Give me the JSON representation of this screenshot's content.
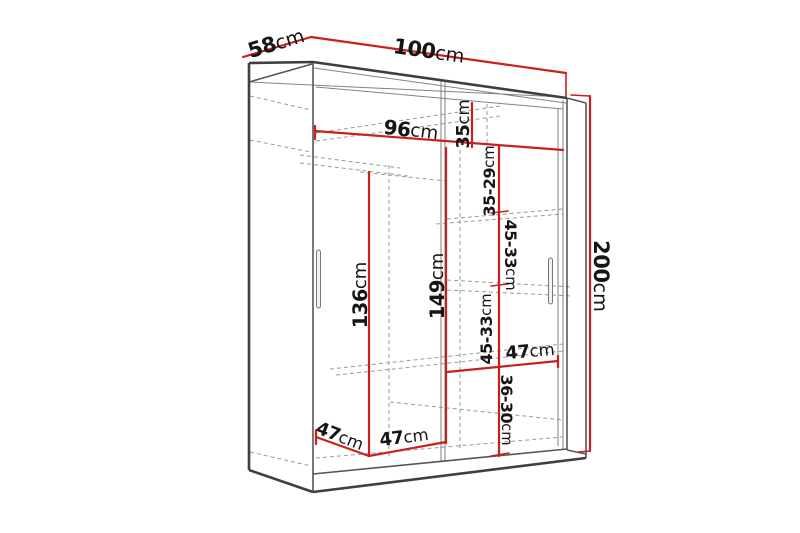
{
  "title": "Wardrobe dimension diagram",
  "diagram": {
    "subject": "two-door sliding wardrobe with interior shelves, perspective line drawing",
    "background_color": "#ffffff",
    "colors": {
      "dimension_line": "#c9201d",
      "outline": "#3f3f3f",
      "hidden_line": "#9a9a9a",
      "label_text": "#151515"
    },
    "unit": "cm",
    "overall": {
      "width": "100cm",
      "depth": "58cm",
      "height": "200cm"
    },
    "dimensions": [
      {
        "id": "depth-top",
        "value": "58",
        "unit": "cm"
      },
      {
        "id": "width-top",
        "value": "100",
        "unit": "cm"
      },
      {
        "id": "interior-width",
        "value": "96",
        "unit": "cm"
      },
      {
        "id": "top-shelf-height",
        "value": "35",
        "unit": "cm"
      },
      {
        "id": "shelf-gap-top",
        "value": "35-29",
        "unit": "cm"
      },
      {
        "id": "shelf-gap-upper",
        "value": "45-33",
        "unit": "cm"
      },
      {
        "id": "shelf-gap-lower",
        "value": "45-33",
        "unit": "cm"
      },
      {
        "id": "right-section-width",
        "value": "47",
        "unit": "cm"
      },
      {
        "id": "shelf-gap-bottom",
        "value": "36-30",
        "unit": "cm"
      },
      {
        "id": "hanging-height",
        "value": "136",
        "unit": "cm"
      },
      {
        "id": "middle-height",
        "value": "149",
        "unit": "cm"
      },
      {
        "id": "height-overall",
        "value": "200",
        "unit": "cm"
      },
      {
        "id": "bottom-depth",
        "value": "47",
        "unit": "cm"
      },
      {
        "id": "left-section-width",
        "value": "47",
        "unit": "cm"
      }
    ]
  }
}
